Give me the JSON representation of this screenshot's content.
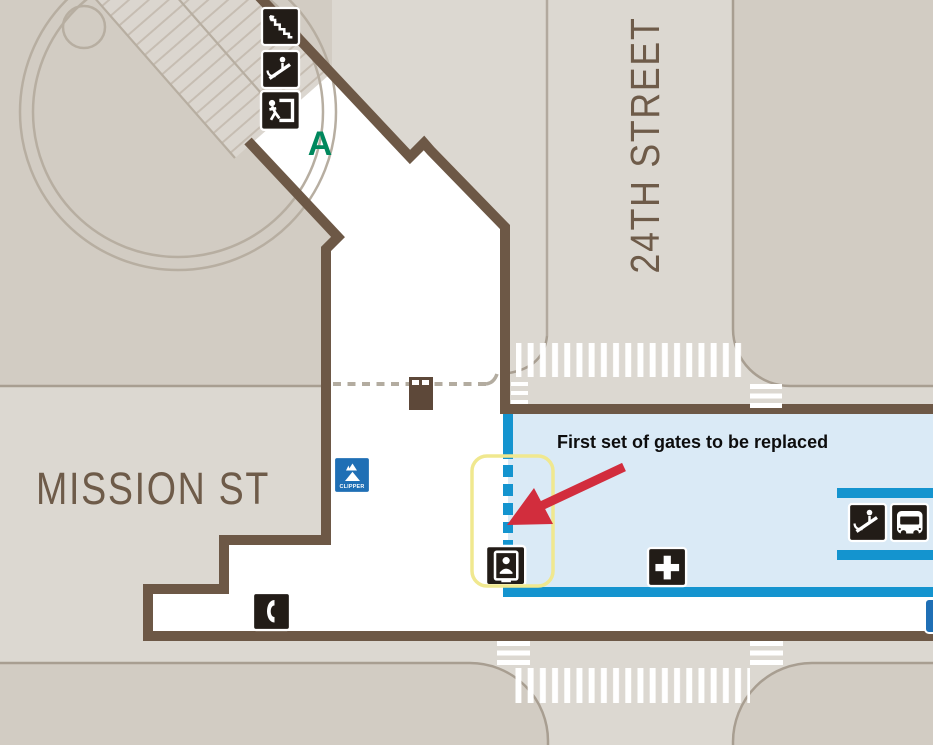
{
  "map": {
    "streets": {
      "mission": "MISSION ST",
      "twenty_fourth": "24TH STREET"
    },
    "labels": {
      "entrance_letter": "A",
      "clipper": "CLIPPER"
    },
    "annotation": {
      "callout_text": "First set of gates to be replaced"
    },
    "icons": [
      "stairs-icon",
      "escalator-icon",
      "exit-icon",
      "clipper-icon",
      "elevator-icon",
      "telephone-icon",
      "first-aid-icon",
      "escalator-icon",
      "bus-icon"
    ],
    "features": [
      "station-concourse",
      "paid-area",
      "fare-gate-dashed-line",
      "agent-booth",
      "plaza-circle",
      "stairway-hatch",
      "crosswalk-north",
      "crosswalk-south",
      "gate-highlight-box",
      "annotation-arrow"
    ],
    "colors": {
      "street_fill": "#dcd8d1",
      "block_fill": "#d2ccc3",
      "block_border": "#a89e91",
      "wall_brown": "#6d5846",
      "paid_area_fill": "#daeaf6",
      "paid_area_blue": "#1494cf",
      "street_text_brown": "#6e5b49",
      "icon_black": "#221c17",
      "exit_green": "#00945f",
      "entrance_letter_green": "#00885d",
      "clipper_blue": "#1f6fb5",
      "highlight_yellow": "#f0e88f",
      "arrow_red": "#d22d3d",
      "booth_brown": "#5d4839"
    }
  }
}
